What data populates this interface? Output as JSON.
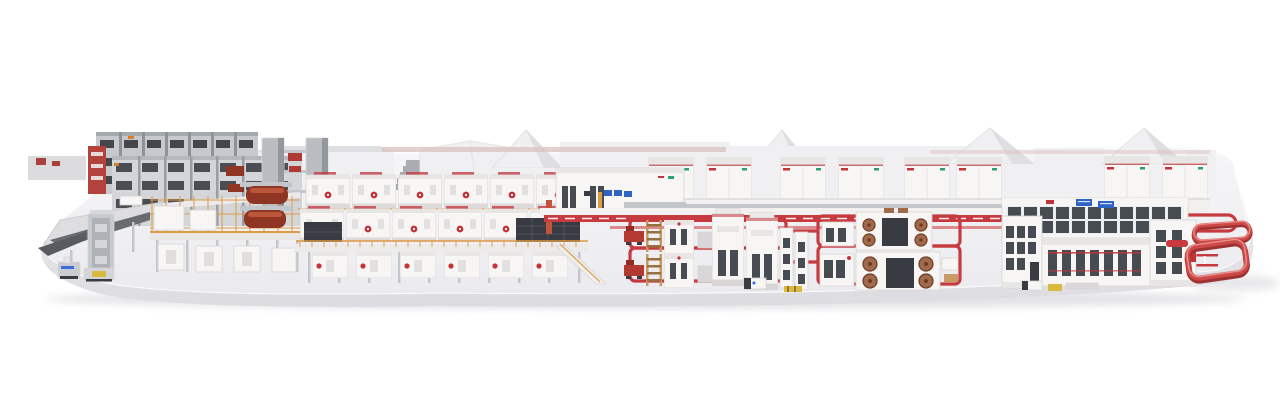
{
  "scene": {
    "palette": {
      "page-bg": "#ffffff",
      "slab-top": "#f6f6f8",
      "slab-top-deep": "#ebebef",
      "slab-face": "#f0f0f3",
      "slab-face-deep": "#dcdce1",
      "slab-shadow": "#ccccd1",
      "machine-white": "#f7f6f5",
      "machine-shade": "#e8e6e4",
      "outline": "#d7d5d3",
      "building": "#f0eff1",
      "building-shade": "#dfdee1",
      "steel": "#c3c6ca",
      "steel-dark": "#90949a",
      "charcoal": "#383c42",
      "slot-dark": "#474b52",
      "accent-red": "#c4333a",
      "loop-red": "#c63a40",
      "loop-red-light": "#dd8a8c",
      "maroon": "#8e3524",
      "roll-brown": "#a26a4c",
      "roll-dark": "#6f3a24",
      "orange": "#de9a45",
      "wood": "#c79a63",
      "wood-dark": "#97713f",
      "screen-blue": "#2f63c6",
      "pallet-yellow": "#d9ba3c",
      "logo-green": "#2f9f72",
      "wall-red-tint": "#d9c4c2",
      "agv-blue": "#3a6fd8"
    },
    "objects": {
      "platform-slab": "white display platform",
      "background-buildings": "plant buildings with gable roofs",
      "roll-storage-racks": "grey paper-roll storage racks",
      "splicer-towers": "roll handling gantry towers",
      "wet-end-mezzanine": "corrugator wet end with paper rolls",
      "corrugator-line": "corrugator machine modules with red roundels",
      "dry-end-cabinets": "dry end cabinets with blue displays",
      "floor-conveyor": "red floor conveyor line",
      "converting-cell-a": "converting machines with pallets and red carts",
      "converting-cell-b": "rotary machines with brown rolls",
      "palletizer-plant": "palletizing and sorting building with screens",
      "elevated-red-loops": "red conveyor loops at shipping end",
      "agvs": "automated guided vehicles",
      "left-dock": "infeed dock with ramps"
    }
  }
}
